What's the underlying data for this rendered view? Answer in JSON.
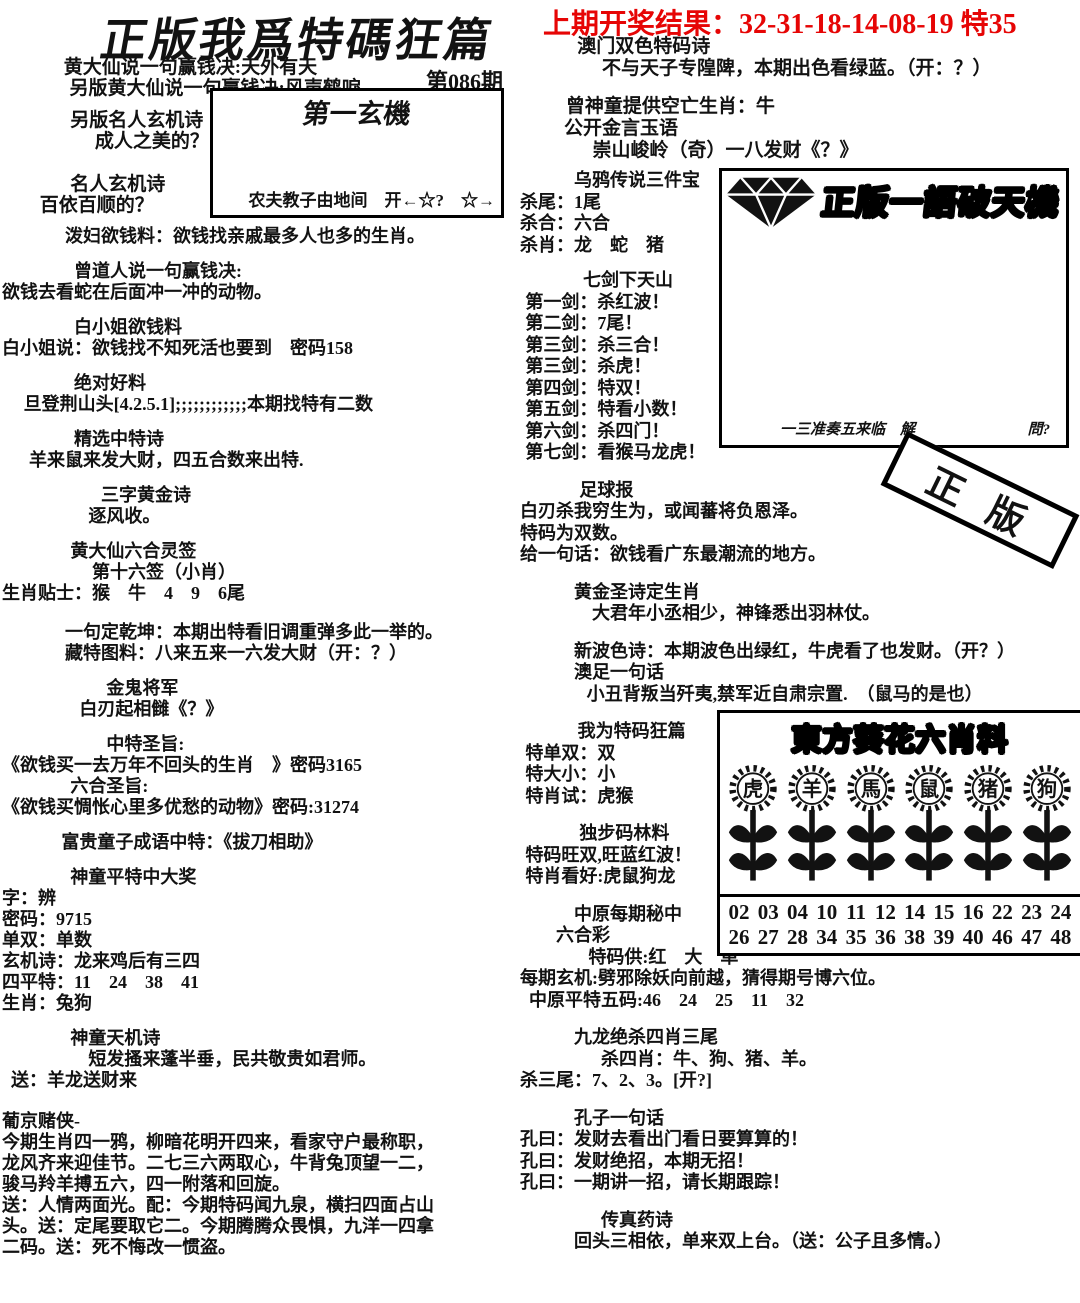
{
  "colors": {
    "accent_red": "#e60505",
    "ink": "#121212",
    "paper": "#ffffff"
  },
  "header": {
    "prev_result": "上期开奖结果：32-31-18-14-08-19 特35",
    "title": "正版我爲特碼狂篇",
    "issue": "第086期",
    "intro_lines": [
      {
        "t": "黄大仙说一句赢钱决:天外有天",
        "pad": 0.2
      },
      {
        "t": "另版黄大仙说一句赢钱决:风声鹤唳",
        "pad": 0.5
      }
    ],
    "mingren_lines": [
      {
        "t": "另版名人玄机诗",
        "pad": 1.8
      },
      {
        "t": "成人之美的？",
        "pad": 3.1
      },
      {
        "t": "名人玄机诗",
        "pad": 1.8,
        "mt": 22
      },
      {
        "t": "百依百顺的？",
        "pad": 0.2
      }
    ]
  },
  "first_box": {
    "title": "第一玄機",
    "footer": "农夫教子由地间　开←☆?　☆→"
  },
  "right_top": {
    "lines": [
      {
        "t": "澳门双色特码诗",
        "pad": 1.7
      },
      {
        "t": "不与天子专隍陴，本期出色看绿蓝。（开：？）",
        "pad": 3
      },
      {
        "t": "曾神童提供空亡生肖：牛",
        "pad": 1.1,
        "mt": 16
      },
      {
        "t": "公开金言玉语",
        "pad": 1
      },
      {
        "t": "崇山峻岭（奇）一八发财《？》",
        "pad": 2.5
      }
    ]
  },
  "left_col": {
    "lines": [
      {
        "t": "泼妇欲钱料：欲钱找亲戚最多人也多的生肖。",
        "pad": 3.5
      },
      {
        "t": "曾道人说一句赢钱决:",
        "pad": 4,
        "mt": 14
      },
      {
        "t": "欲钱去看蛇在后面冲一冲的动物。",
        "pad": 0
      },
      {
        "t": "白小姐欲钱料",
        "pad": 4,
        "mt": 14
      },
      {
        "t": "白小姐说：欲钱找不知死活也要到　密码158",
        "pad": 0
      },
      {
        "t": "绝对好料",
        "pad": 4,
        "mt": 14
      },
      {
        "t": "旦登荆山头[4.2.5.1];;;;;;;;;;;;本期找特有二数",
        "pad": 1.2
      },
      {
        "t": "精选中特诗",
        "pad": 4,
        "mt": 14
      },
      {
        "t": "羊来鼠来发大财，四五合数来出特.",
        "pad": 1.5
      },
      {
        "t": "三字黄金诗",
        "pad": 5.5,
        "mt": 14
      },
      {
        "t": "逐风收。",
        "pad": 4.8
      },
      {
        "t": "黄大仙六合灵签",
        "pad": 3.8,
        "mt": 14
      },
      {
        "t": "第十六签（小肖）",
        "pad": 5
      },
      {
        "t": "生肖贴士：猴　牛　4　9　6尾",
        "pad": 0
      },
      {
        "t": "一句定乾坤：本期出特看旧调重弹多此一举的。",
        "pad": 3.5,
        "mt": 18
      },
      {
        "t": "藏特图料：八来五来一六发大财（开：？）",
        "pad": 3.5
      },
      {
        "t": "金鬼将军",
        "pad": 5.8,
        "mt": 14
      },
      {
        "t": "白刃起相雠《？》",
        "pad": 4.3
      },
      {
        "t": "中特圣旨:",
        "pad": 5.8,
        "mt": 14
      },
      {
        "t": "《欲钱买一去万年不回头的生肖　》密码3165",
        "pad": 0
      },
      {
        "t": "六合圣旨:",
        "pad": 3.8
      },
      {
        "t": "《欲钱买惆怅心里多优愁的动物》密码:31274",
        "pad": 0
      },
      {
        "t": "富贵童子成语中特：《拔刀相助》",
        "pad": 3.3,
        "mt": 14
      },
      {
        "t": "神童平特中大奖",
        "pad": 3.8,
        "mt": 14
      },
      {
        "t": "字：辨",
        "pad": 0
      },
      {
        "t": "密码：9715",
        "pad": 0
      },
      {
        "t": "单双：单数",
        "pad": 0
      },
      {
        "t": "玄机诗：龙来鸡后有三四",
        "pad": 0
      },
      {
        "t": "四平特：11　24　38　41",
        "pad": 0
      },
      {
        "t": "生肖：兔狗",
        "pad": 0
      },
      {
        "t": "神童天机诗",
        "pad": 3.8,
        "mt": 14
      },
      {
        "t": "短发搔来蓬半垂，民共敬贵如君师。",
        "pad": 4.8
      },
      {
        "t": "送：羊龙送财来",
        "pad": 0.5
      },
      {
        "t": "葡京赌侠-",
        "pad": 0,
        "mt": 20
      },
      {
        "t": "今期生肖四一鸦，柳暗花明开四来，看家守户最称职，",
        "pad": 0
      },
      {
        "t": "龙风齐来迎佳节。二七三六两取心，牛背兔顶望一二，",
        "pad": 0
      },
      {
        "t": "骏马羚羊搏五六，四一附落和回旋。",
        "pad": 0
      },
      {
        "t": "送：人情两面光。配：今期特码闻九泉，横扫四面占山",
        "pad": 0
      },
      {
        "t": "头。送：定尾要取它二。今期腾腾众畏惧，九洋一四拿",
        "pad": 0
      },
      {
        "t": "二码。送：死不悔改一惯盗。",
        "pad": 0
      }
    ]
  },
  "mid_col": {
    "lines": [
      {
        "t": "乌鸦传说三件宝",
        "pad": 3
      },
      {
        "t": "杀尾：1尾",
        "pad": 0
      },
      {
        "t": "杀合：六合",
        "pad": 0
      },
      {
        "t": "杀肖：龙　蛇　猪",
        "pad": 0
      },
      {
        "t": "七剑下天山",
        "pad": 3.5,
        "mt": 14
      },
      {
        "t": "第一剑：杀红波！",
        "pad": 0.3
      },
      {
        "t": "第二剑：7尾！",
        "pad": 0.3
      },
      {
        "t": "第三剑：杀三合！",
        "pad": 0.3
      },
      {
        "t": "第三剑：杀虎！",
        "pad": 0.3
      },
      {
        "t": "第四剑：特双！",
        "pad": 0.3
      },
      {
        "t": "第五剑：特看小数！",
        "pad": 0.3
      },
      {
        "t": "第六剑：杀四门！",
        "pad": 0.3
      },
      {
        "t": "第七剑：看猴马龙虎！",
        "pad": 0.3
      },
      {
        "t": "足球报",
        "pad": 3.3,
        "mt": 16
      },
      {
        "t": "白刃杀我穷生为，或闻蕃将负恩泽。",
        "pad": 0
      },
      {
        "t": "特码为双数。",
        "pad": 0
      },
      {
        "t": "给一句话：欲钱看广东最潮流的地方。",
        "pad": 0
      },
      {
        "t": "黄金圣诗定生肖",
        "pad": 3,
        "mt": 16
      },
      {
        "t": "大君年小丞相少，神锋悉出羽林仗。",
        "pad": 4
      },
      {
        "t": "新波色诗：本期波色出绿红，牛虎看了也发财。（开？）",
        "pad": 3,
        "mt": 16
      },
      {
        "t": "澳足一句话",
        "pad": 3
      },
      {
        "t": "小丑背叛当歼夷,禁军近自肃宗置.　（鼠马的是也）",
        "pad": 3.7
      },
      {
        "t": "我为特码狂篇",
        "pad": 3.2,
        "mt": 16
      },
      {
        "t": "特单双：双",
        "pad": 0.3
      },
      {
        "t": "特大小：小",
        "pad": 0.3
      },
      {
        "t": "特肖试：虎猴",
        "pad": 0.3
      },
      {
        "t": "独步码林料",
        "pad": 3.3,
        "mt": 16
      },
      {
        "t": "特码旺双,旺蓝红波！",
        "pad": 0.3
      },
      {
        "t": "特肖看好:虎鼠狗龙",
        "pad": 0.3
      },
      {
        "t": "中原每期秘中",
        "pad": 3,
        "mt": 16
      },
      {
        "t": "六合彩",
        "pad": 2
      },
      {
        "t": "特码供:红　大　单",
        "pad": 3.8
      },
      {
        "t": "每期玄机:劈邪除妖向前越，猜得期号博六位。",
        "pad": 0
      },
      {
        "t": "中原平特五码:46　24　25　11　32",
        "pad": 0.5
      },
      {
        "t": "九龙绝杀四肖三尾",
        "pad": 3,
        "mt": 16
      },
      {
        "t": "杀四肖：牛、狗、猪、羊。",
        "pad": 4.5
      },
      {
        "t": "杀三尾：7、2、3。[开?]",
        "pad": 0
      },
      {
        "t": "孔子一句话",
        "pad": 3,
        "mt": 16
      },
      {
        "t": "孔曰：发财去看出门看日要算算的！",
        "pad": 0
      },
      {
        "t": "孔曰：发财绝招，本期无招！",
        "pad": 0
      },
      {
        "t": "孔曰：一期讲一招，请长期跟踪！",
        "pad": 0
      },
      {
        "t": "传真药诗",
        "pad": 4.5,
        "mt": 16
      },
      {
        "t": "回头三相依，单来双上台。（送：公子且多情。）",
        "pad": 3
      }
    ]
  },
  "diamond_box": {
    "title": "正版一語破天機",
    "footer_left": "一三准奏五来临　解",
    "footer_right": "問?"
  },
  "stamp": {
    "text": "正版"
  },
  "sunflower_box": {
    "title": "東方葵花六肖料",
    "flowers": [
      "虎",
      "羊",
      "馬",
      "鼠",
      "猪",
      "狗"
    ],
    "numbers_row1": [
      "02",
      "03",
      "04",
      "10",
      "11",
      "12",
      "14",
      "15",
      "16",
      "22",
      "23",
      "24"
    ],
    "numbers_row2": [
      "26",
      "27",
      "28",
      "34",
      "35",
      "36",
      "38",
      "39",
      "40",
      "46",
      "47",
      "48"
    ]
  }
}
